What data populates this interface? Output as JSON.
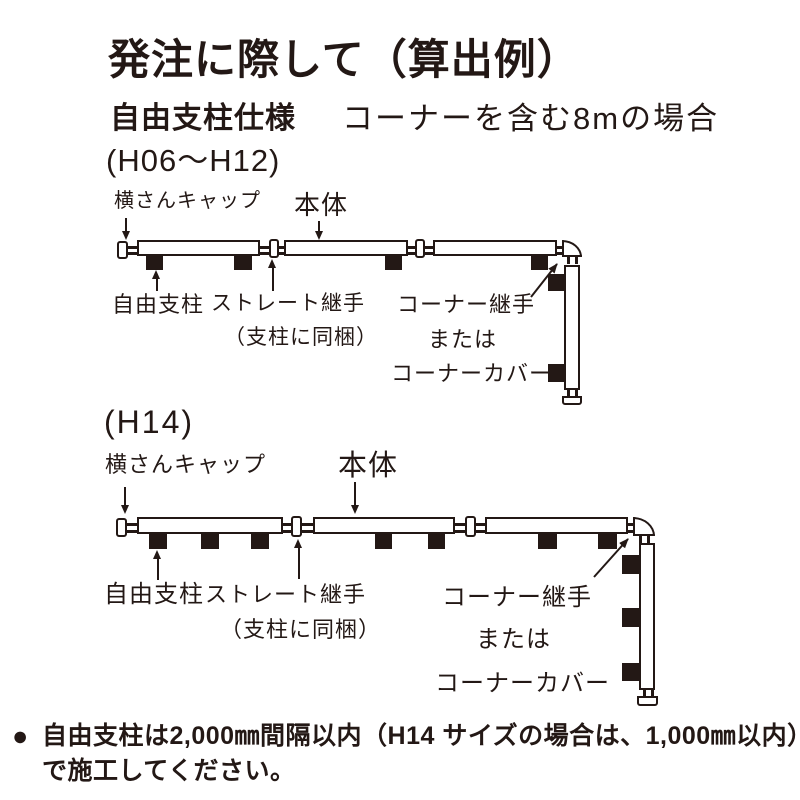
{
  "header": {
    "title": "発注に際して（算出例）",
    "spec_label": "自由支柱仕様",
    "spec_case": "コーナーを含む8mの場合"
  },
  "diagrams": [
    {
      "size_range": "(H06〜H12)",
      "labels": {
        "cap": "横さんキャップ",
        "body": "本体",
        "post": "自由支柱",
        "joint": "ストレート継手",
        "joint_note": "（支柱に同梱）",
        "corner_line1": "コーナー継手",
        "corner_line2": "または",
        "corner_line3": "コーナーカバー"
      }
    },
    {
      "size_range": "(H14)",
      "labels": {
        "cap": "横さんキャップ",
        "body": "本体",
        "post": "自由支柱",
        "joint": "ストレート継手",
        "joint_note": "（支柱に同梱）",
        "corner_line1": "コーナー継手",
        "corner_line2": "または",
        "corner_line3": "コーナーカバー"
      }
    }
  ],
  "footnote": {
    "bullet": "●",
    "line1": "自由支柱は2,000㎜間隔以内（H14 サイズの場合は、1,000㎜以内）",
    "line2": "で施工してください。"
  },
  "colors": {
    "ink": "#231815",
    "background": "#ffffff"
  }
}
